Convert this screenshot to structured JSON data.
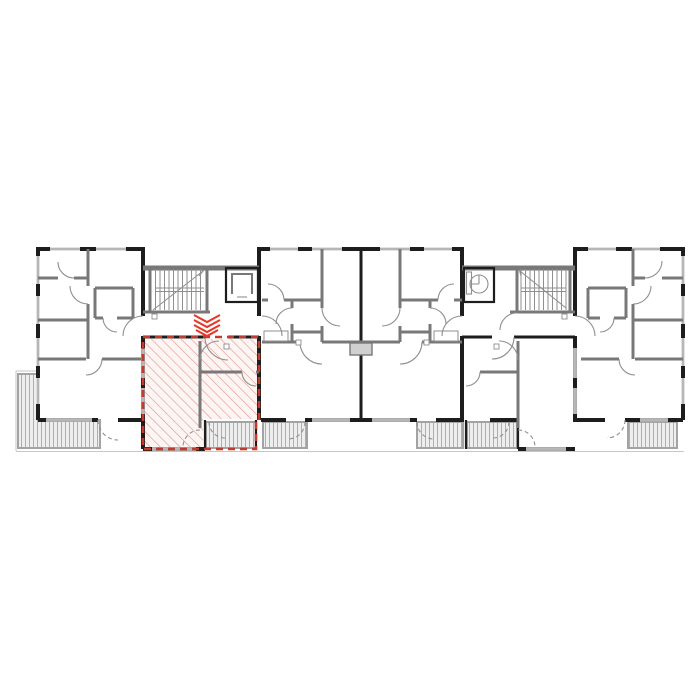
{
  "title": "Building floor plan with highlighted apartment",
  "colors": {
    "paper": "#ffffff",
    "wall_exterior": "#1d1d1d",
    "wall_interior": "#787878",
    "wall_light": "#8f8f8f",
    "line_thin": "#c6c6c6",
    "window_band": "#dcdcdc",
    "window_line": "#8f8f8f",
    "door_arc": "#8f8f8f",
    "hatch_red": "#de968b",
    "hatch_red_bg": "#fdf5f3",
    "unit_outline_red": "#c23b2c",
    "marker_red": "#e6392a",
    "balcony_line": "#a3a3a3",
    "balcony_bg": "#eeeeee"
  },
  "plan": {
    "selected_unit": {
      "name": "selected-apartment",
      "hatch_style": "red-diagonal",
      "marker_icon": "chevron-down-icon"
    },
    "features": [
      "left-apartment",
      "selected-apartment",
      "center-apartment-left",
      "center-apartment-right",
      "apartment-below-right-core",
      "right-apartment",
      "stairwell-left",
      "elevator-left",
      "stairwell-right",
      "elevator-right",
      "terrace",
      "balcony-1",
      "balcony-2",
      "balcony-3",
      "balcony-4",
      "balcony-5"
    ]
  }
}
